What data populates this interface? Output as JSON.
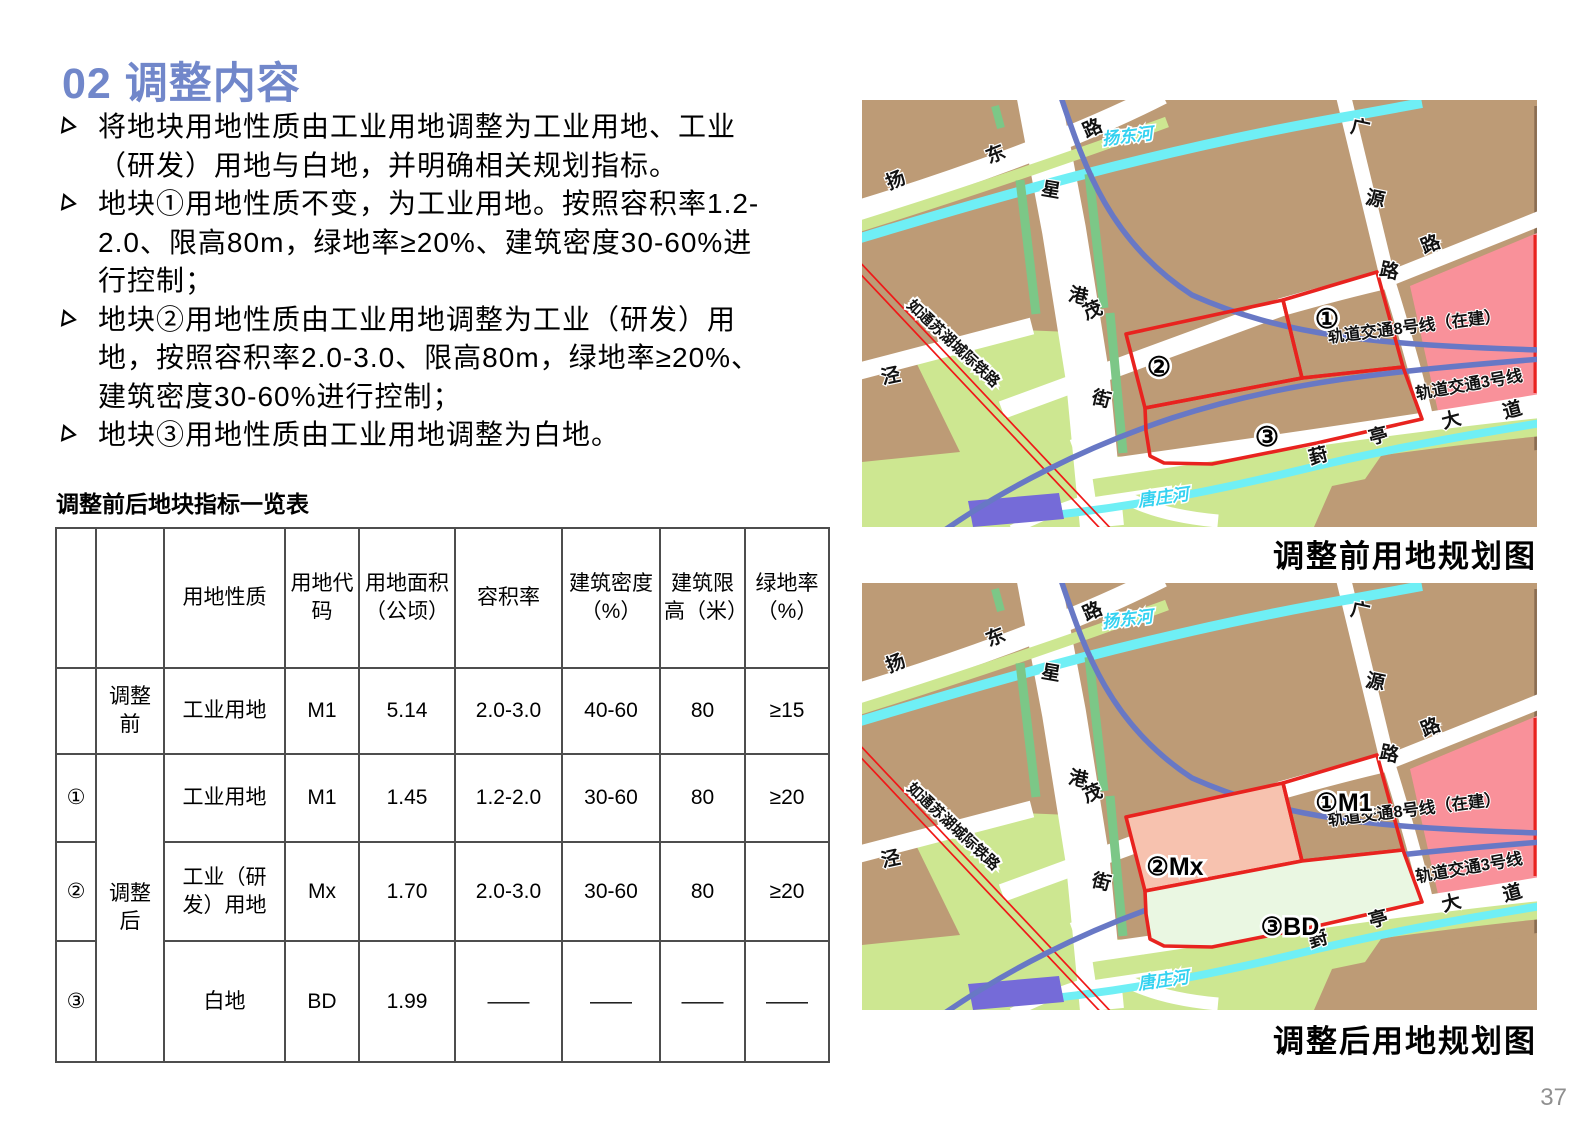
{
  "page": {
    "title": "02 调整内容",
    "title_color": "#7187CA",
    "page_number": "37"
  },
  "bullets": [
    "将地块用地性质由工业用地调整为工业用地、工业（研发）用地与白地，并明确相关规划指标。",
    "地块①用地性质不变，为工业用地。按照容积率1.2-2.0、限高80m，绿地率≥20%、建筑密度30-60%进行控制；",
    "地块②用地性质由工业用地调整为工业（研发）用地，按照容积率2.0-3.0、限高80m，绿地率≥20%、建筑密度30-60%进行控制；",
    "地块③用地性质由工业用地调整为白地。"
  ],
  "table": {
    "title": "调整前后地块指标一览表",
    "headers": [
      "",
      "",
      "用地性质",
      "用地代码",
      "用地面积（公顷）",
      "容积率",
      "建筑密度（%）",
      "建筑限高（米）",
      "绿地率（%）"
    ],
    "rows": [
      {
        "cells": [
          {
            "t": ""
          },
          {
            "t": "调整前"
          },
          {
            "t": "工业用地"
          },
          {
            "t": "M1"
          },
          {
            "t": "5.14"
          },
          {
            "t": "2.0-3.0"
          },
          {
            "t": "40-60"
          },
          {
            "t": "80"
          },
          {
            "t": "≥15"
          }
        ]
      },
      {
        "cells": [
          {
            "t": "①"
          },
          {
            "t": "调整后",
            "rowspan": 3
          },
          {
            "t": "工业用地"
          },
          {
            "t": "M1"
          },
          {
            "t": "1.45"
          },
          {
            "t": "1.2-2.0"
          },
          {
            "t": "30-60"
          },
          {
            "t": "80"
          },
          {
            "t": "≥20"
          }
        ]
      },
      {
        "cells": [
          {
            "t": "②"
          },
          {
            "t": "工业（研发）用地"
          },
          {
            "t": "Mx"
          },
          {
            "t": "1.70"
          },
          {
            "t": "2.0-3.0"
          },
          {
            "t": "30-60"
          },
          {
            "t": "80"
          },
          {
            "t": "≥20"
          }
        ]
      },
      {
        "cells": [
          {
            "t": "③"
          },
          {
            "t": "白地"
          },
          {
            "t": "BD"
          },
          {
            "t": "1.99"
          },
          {
            "t": "——"
          },
          {
            "t": "——"
          },
          {
            "t": "——"
          },
          {
            "t": "——"
          }
        ]
      }
    ]
  },
  "maps": {
    "colors": {
      "block_tan": "#BD9B76",
      "park_green": "#CDE791",
      "strip_green": "#7CC787",
      "river_cyan": "#6FEFF5",
      "river_label": "#35D2F0",
      "metro_blue": "#6878C5",
      "rail_red": "#F01818",
      "zone_pink": "#F9919A",
      "purple": "#756BD8",
      "parcel_red": "#E8231F",
      "p2_fill_after": "#F7C2AF",
      "p3_fill_after": "#EAF7E2",
      "edge_brown": "#8A6D52"
    },
    "road_chars": [
      {
        "t": "扬",
        "x": 36,
        "y": 86,
        "r": -22
      },
      {
        "t": "东",
        "x": 136,
        "y": 60,
        "r": -22
      },
      {
        "t": "路",
        "x": 233,
        "y": 34,
        "r": -24
      },
      {
        "t": "星",
        "x": 188,
        "y": 96,
        "r": 10
      },
      {
        "t": "港",
        "x": 215,
        "y": 202,
        "r": 12
      },
      {
        "t": "街",
        "x": 238,
        "y": 305,
        "r": 14
      },
      {
        "t": "茂",
        "x": 233,
        "y": 216,
        "r": -22
      },
      {
        "t": "路",
        "x": 571,
        "y": 150,
        "r": -22
      },
      {
        "t": "广",
        "x": 497,
        "y": 34,
        "r": 12
      },
      {
        "t": "源",
        "x": 512,
        "y": 105,
        "r": 12
      },
      {
        "t": "路",
        "x": 526,
        "y": 177,
        "r": 12
      },
      {
        "t": "泾",
        "x": 30,
        "y": 282,
        "r": -12
      },
      {
        "t": "葑",
        "x": 458,
        "y": 362,
        "r": -15
      },
      {
        "t": "亭",
        "x": 518,
        "y": 342,
        "r": -15
      },
      {
        "t": "大",
        "x": 591,
        "y": 326,
        "r": -15
      },
      {
        "t": "道",
        "x": 652,
        "y": 316,
        "r": -15
      }
    ],
    "river_labels": [
      {
        "t": "扬东河",
        "x": 266,
        "y": 42,
        "r": -7
      },
      {
        "t": "唐庄河",
        "x": 302,
        "y": 403,
        "r": -8
      }
    ],
    "metro_labels": [
      {
        "t": "轨道交通8号线（在建）",
        "x": 553,
        "y": 232,
        "r": -7
      },
      {
        "t": "轨道交通3号线",
        "x": 608,
        "y": 290,
        "r": -10
      }
    ],
    "railway_label": {
      "t": "如通苏湖城际铁路",
      "x": 88,
      "y": 247,
      "r": 43
    },
    "before": {
      "caption": "调整前用地规划图",
      "parcel_labels": [
        {
          "t": "①",
          "x": 465,
          "y": 228,
          "fs": 27
        },
        {
          "t": "②",
          "x": 297,
          "y": 276,
          "fs": 27
        },
        {
          "t": "③",
          "x": 405,
          "y": 346,
          "fs": 27
        }
      ],
      "fills": {
        "p1": "transparent",
        "p2": "transparent",
        "p3": "transparent"
      }
    },
    "after": {
      "caption": "调整后用地规划图",
      "parcel_labels": [
        {
          "t": "①M1",
          "x": 482,
          "y": 228,
          "fs": 25
        },
        {
          "t": "②Mx",
          "x": 313,
          "y": 292,
          "fs": 25
        },
        {
          "t": "③BD",
          "x": 428,
          "y": 352,
          "fs": 25
        }
      ],
      "fills": {
        "p1": "transparent",
        "p2": "#F7C2AF",
        "p3": "#EAF7E2"
      }
    }
  }
}
